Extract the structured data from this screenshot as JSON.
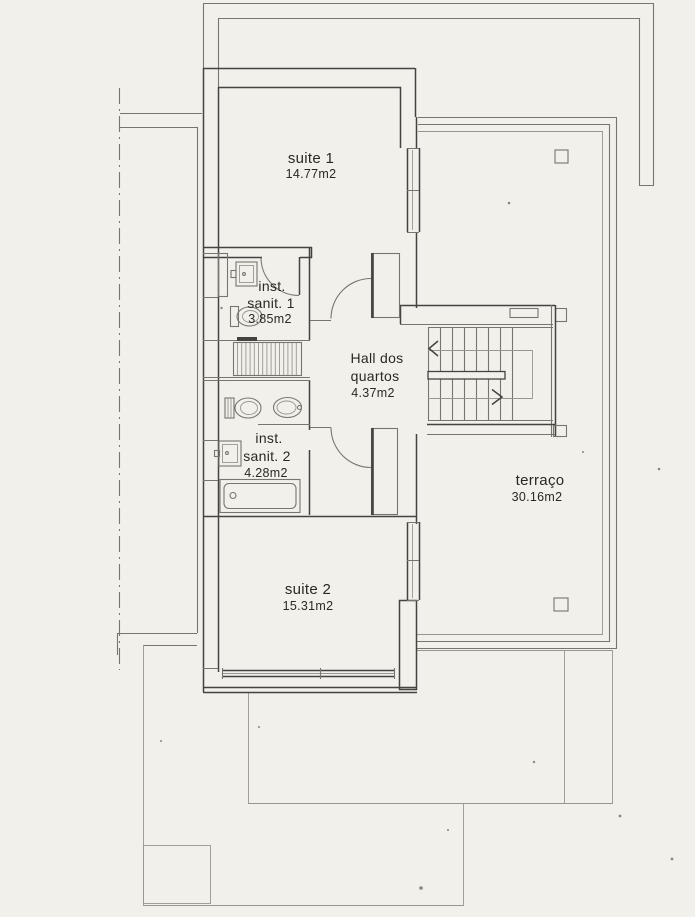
{
  "colors": {
    "paper": "#f2f0eb",
    "line_light": "#9a968f",
    "line_mid": "#78756e",
    "line_dark": "#454340",
    "text": "#2b2823"
  },
  "rooms": {
    "suite1": {
      "name": "suite 1",
      "area": "14.77m2"
    },
    "sanit1": {
      "l1": "inst.",
      "l2": "sanit. 1",
      "area": "3.85m2"
    },
    "hall": {
      "l1": "Hall dos",
      "l2": "quartos",
      "area": "4.37m2"
    },
    "sanit2": {
      "l1": "inst.",
      "l2": "sanit. 2",
      "area": "4.28m2"
    },
    "terraco": {
      "name": "terraço",
      "area": "30.16m2"
    },
    "suite2": {
      "name": "suite 2",
      "area": "15.31m2"
    }
  }
}
